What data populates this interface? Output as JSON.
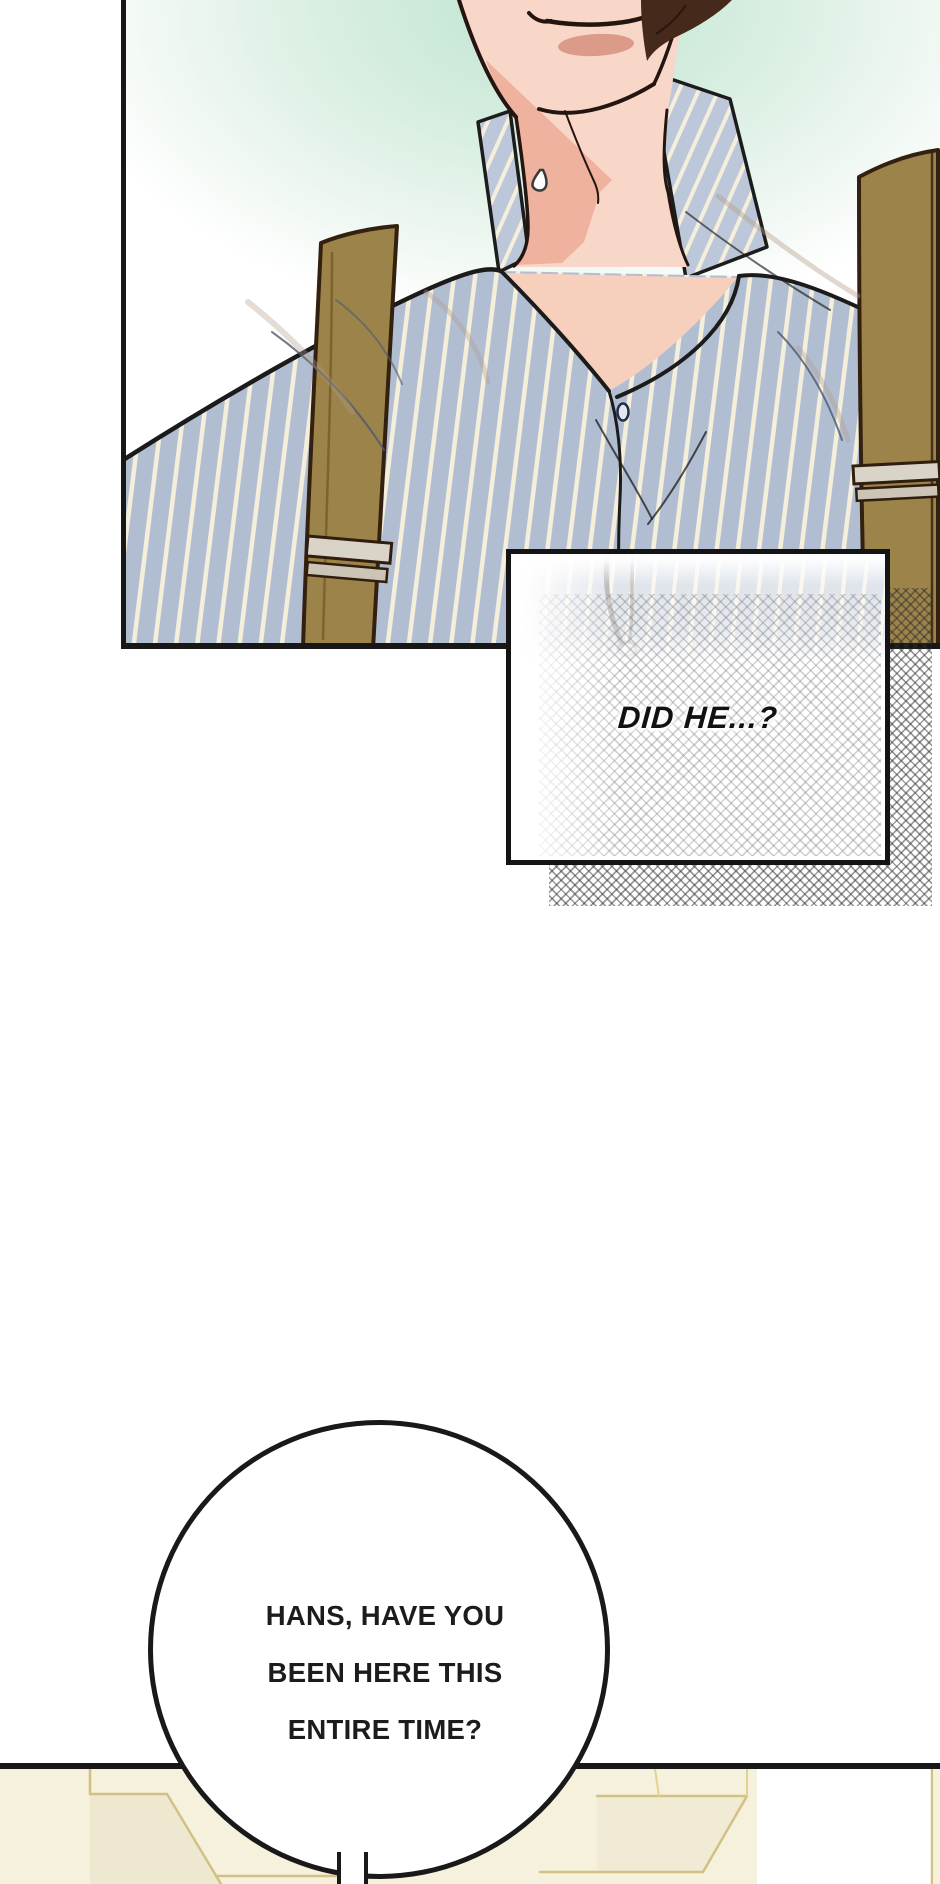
{
  "page": {
    "type": "webtoon-comic-page",
    "background": "#ffffff"
  },
  "panels": {
    "top_panel": {
      "subject": "man-torso-striped-shirt-suspenders",
      "background_tint": "#bfe4d2",
      "shirt_base": "#b1bed2",
      "shirt_stripe": "#f4eedb",
      "suspender": "#9c8349",
      "skin": "#f8d7c8",
      "outline": "#1b1b1b"
    },
    "bottom_panel": {
      "subject": "cream-furniture-edge",
      "fill": "#f6f1dd",
      "line": "#d2c184"
    }
  },
  "narration": {
    "text": "DID HE...?"
  },
  "speech_bubble": {
    "lines": [
      "HANS, HAVE YOU",
      "BEEN HERE THIS",
      "ENTIRE TIME?"
    ]
  }
}
